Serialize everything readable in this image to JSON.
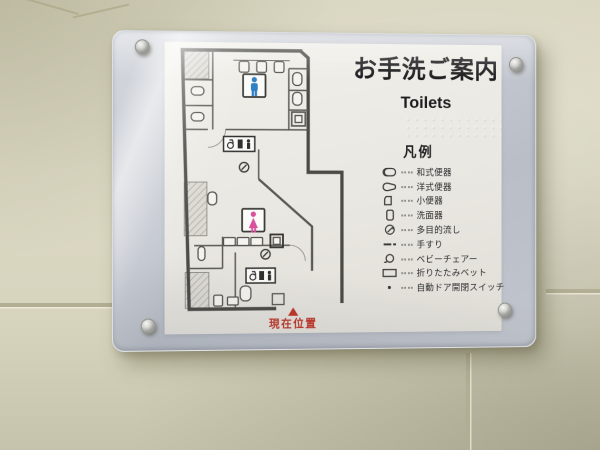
{
  "sign": {
    "title": "お手洗ご案内",
    "subtitle": "Toilets",
    "legend_title": "凡例",
    "legend": [
      {
        "icon": "squat-toilet-icon",
        "label": "和式便器"
      },
      {
        "icon": "western-toilet-icon",
        "label": "洋式便器"
      },
      {
        "icon": "urinal-icon",
        "label": "小便器"
      },
      {
        "icon": "washbasin-icon",
        "label": "洗面器"
      },
      {
        "icon": "multipurpose-sink-icon",
        "label": "多目的流し"
      },
      {
        "icon": "handrail-icon",
        "label": "手すり"
      },
      {
        "icon": "baby-chair-icon",
        "label": "ベビーチェアー"
      },
      {
        "icon": "folding-bed-icon",
        "label": "折りたたみベット"
      },
      {
        "icon": "auto-door-switch-icon",
        "label": "自動ドア開閉スイッチ"
      }
    ],
    "current_location": "現在位置",
    "map_pictograms": {
      "mens": "male",
      "womens": "female"
    },
    "colors": {
      "male_blue": "#2f7fc4",
      "female_pink": "#d9509c",
      "location_red": "#bf3529",
      "wall_line": "#4a4a46",
      "glass_panel": "#c3c7cf",
      "wall_tile": "#d6d3bd"
    }
  }
}
